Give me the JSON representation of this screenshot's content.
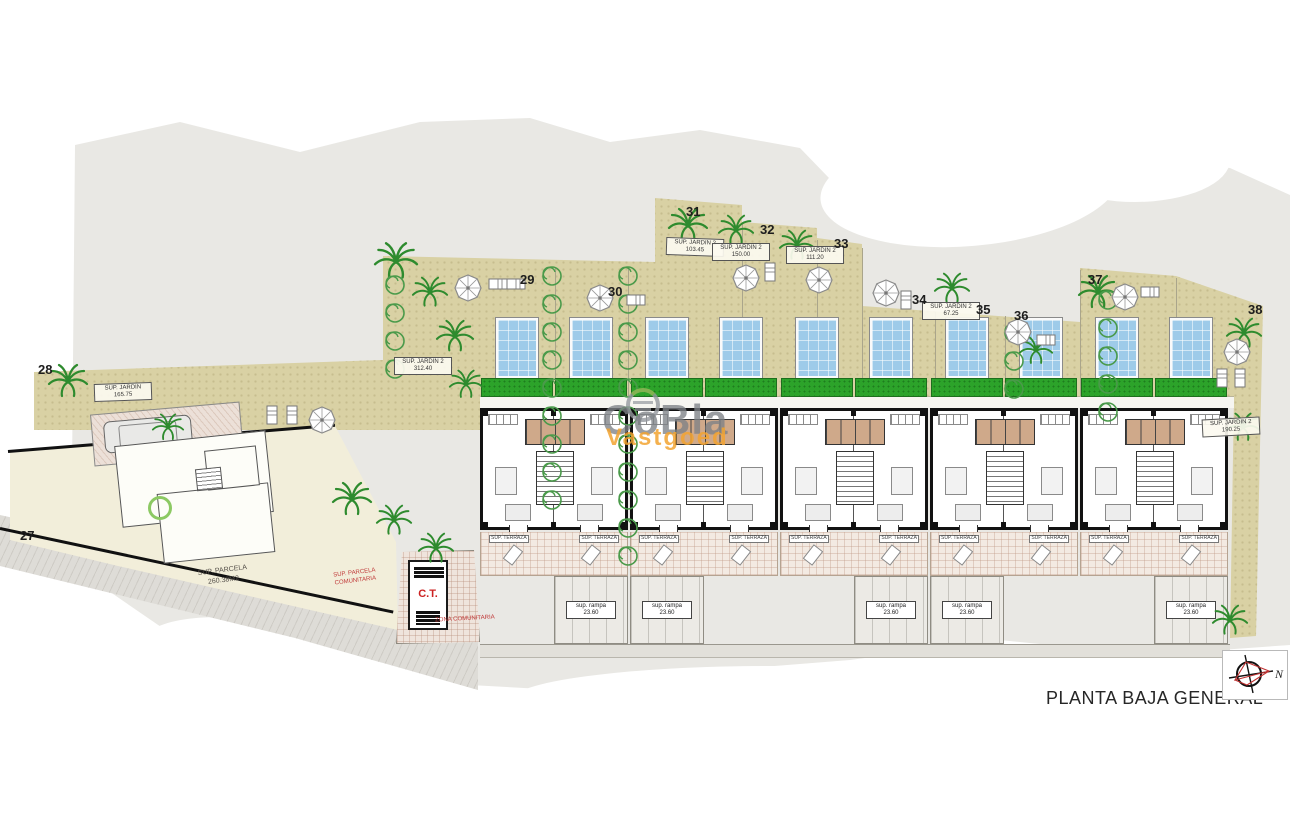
{
  "page": {
    "title": "PLANTA BAJA GENERAL",
    "compass_label": "N"
  },
  "watermark": {
    "brand": "CoBla",
    "sub": "Vastgoed"
  },
  "plot_numbers": [
    "27",
    "28",
    "29",
    "30",
    "31",
    "32",
    "33",
    "34",
    "35",
    "36",
    "37",
    "38"
  ],
  "area_labels": {
    "parcela27": {
      "line1": "SUP. PARCELA",
      "line2": "260.38M2"
    },
    "jardin28": {
      "line1": "SUP. JARDIN",
      "line2": "165.75"
    },
    "jardin29": {
      "line1": "SUP. JARDIN 2",
      "line2": "312.40"
    },
    "jardin31": {
      "line1": "SUP. JARDIN 2",
      "line2": "103.45"
    },
    "jardin32": {
      "line1": "SUP. JARDIN 2",
      "line2": "150.00"
    },
    "jardin33": {
      "line1": "SUP. JARDIN 2",
      "line2": "111.20"
    },
    "jardin35": {
      "line1": "SUP. JARDIN 2",
      "line2": "67.25"
    },
    "jardin38": {
      "line1": "SUP. JARDIN 2",
      "line2": "190.25"
    }
  },
  "transformer": {
    "label": "C.T.",
    "note_left": "SUP. PARCELA COMUNITARIA",
    "note_bottom": "ZONA COMUNITARIA"
  },
  "unit_strips": {
    "garden": {
      "line1": "SUP. JARDIN 1",
      "line2": "25.05"
    },
    "ramp": {
      "line1": "sup. rampa",
      "line2": "23.60"
    },
    "terrace": {
      "line1": "SUP. TERRAZA"
    }
  },
  "villas": {
    "count": 10,
    "strip_pattern": [
      "garden",
      "ramp",
      "ramp",
      "garden",
      "garden",
      "ramp",
      "ramp",
      "garden",
      "garden",
      "ramp"
    ]
  },
  "colors": {
    "garden_beige": "#d9d1a4",
    "grass_green": "#2ca32a",
    "pool_blue": "#9ecbe9",
    "accent_red": "#c22222",
    "watermark_gray": "#7d8186",
    "watermark_orange": "#f2a330"
  }
}
